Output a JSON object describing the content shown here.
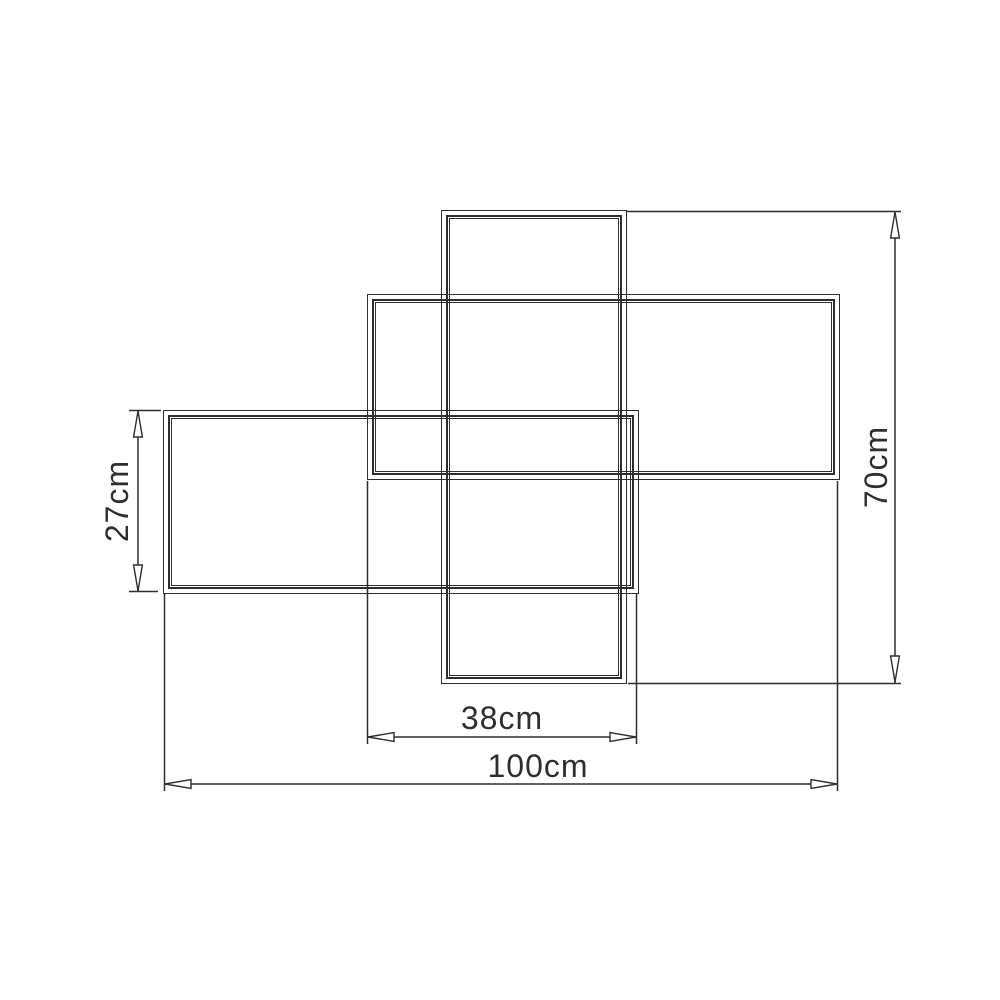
{
  "diagram": {
    "description": "Technical dimension drawing of three overlapping rectangular frames (pinwheel arrangement)",
    "line_color": "#2e2e2e",
    "background_color": "#ffffff",
    "dimensions": {
      "left_height": "27cm",
      "right_height": "70cm",
      "center_width": "38cm",
      "overall_width": "100cm"
    }
  }
}
